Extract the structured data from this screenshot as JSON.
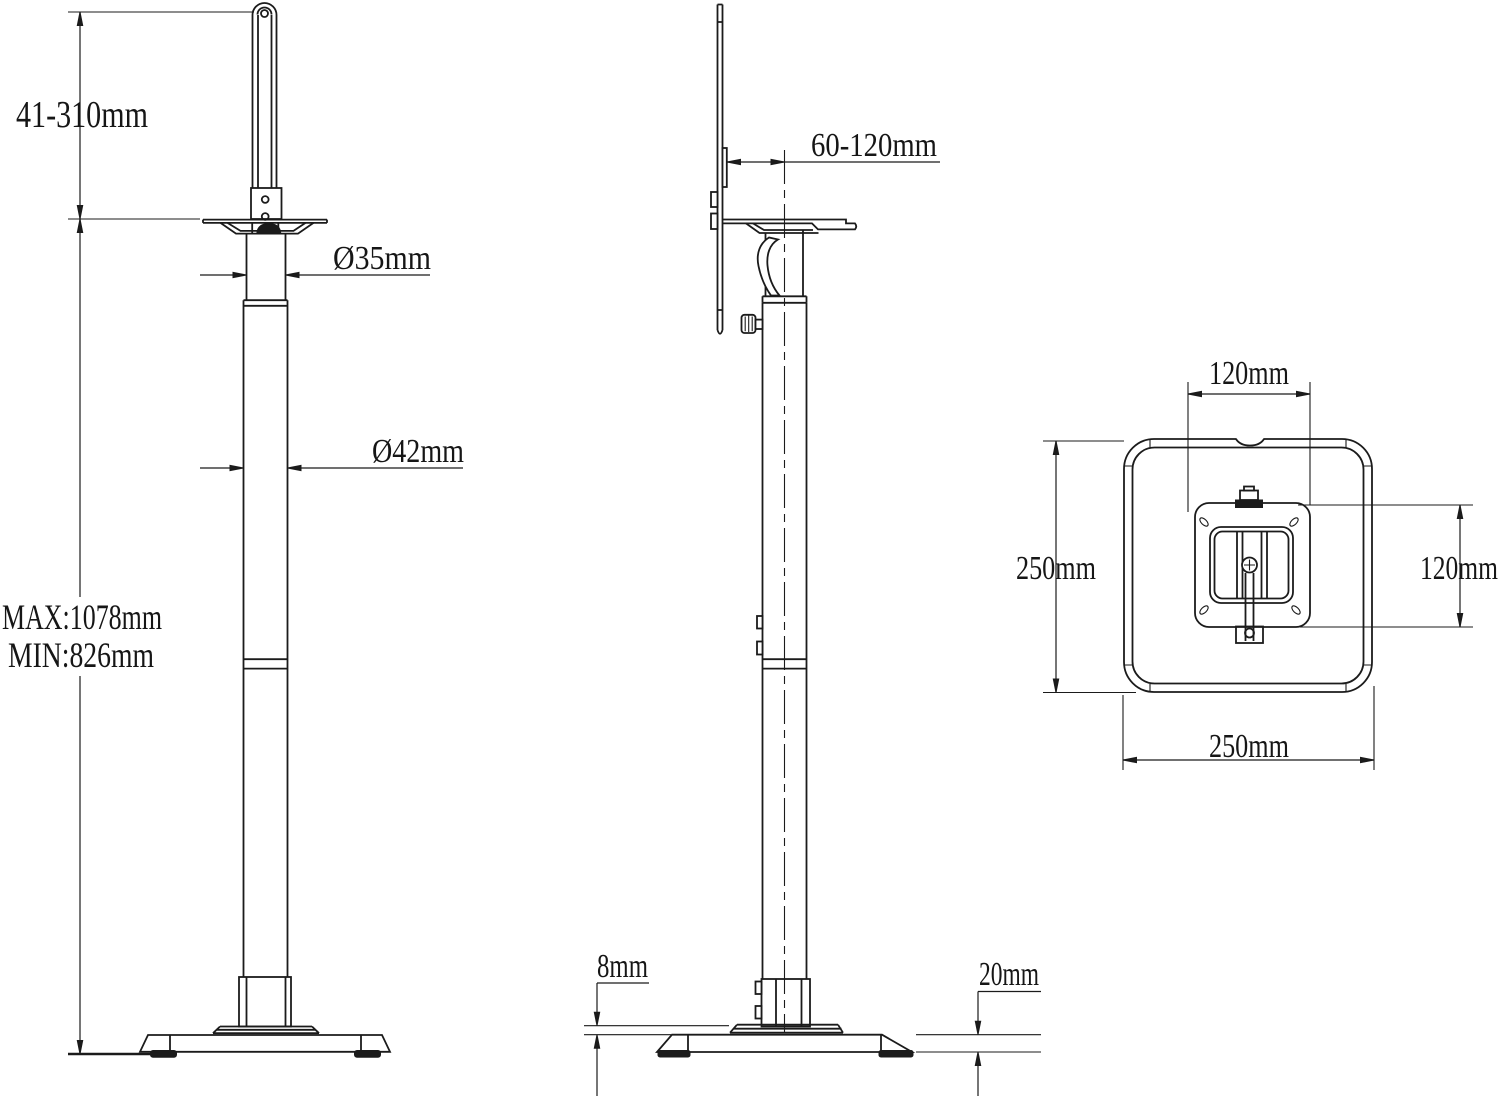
{
  "colors": {
    "line": "#1b1b1b",
    "background": "#ffffff"
  },
  "front_view": {
    "bracket_height_range": "41-310mm",
    "upper_pole_diameter": "Ø35mm",
    "lower_pole_diameter": "Ø42mm",
    "max_height": "MAX:1078mm",
    "min_height": "MIN:826mm"
  },
  "side_view": {
    "bracket_depth_range": "60-120mm",
    "top_plate_thickness": "8mm",
    "base_thickness": "20mm"
  },
  "top_view": {
    "mount_plate_width": "120mm",
    "mount_plate_depth": "120mm",
    "base_width": "250mm",
    "base_depth": "250mm"
  }
}
